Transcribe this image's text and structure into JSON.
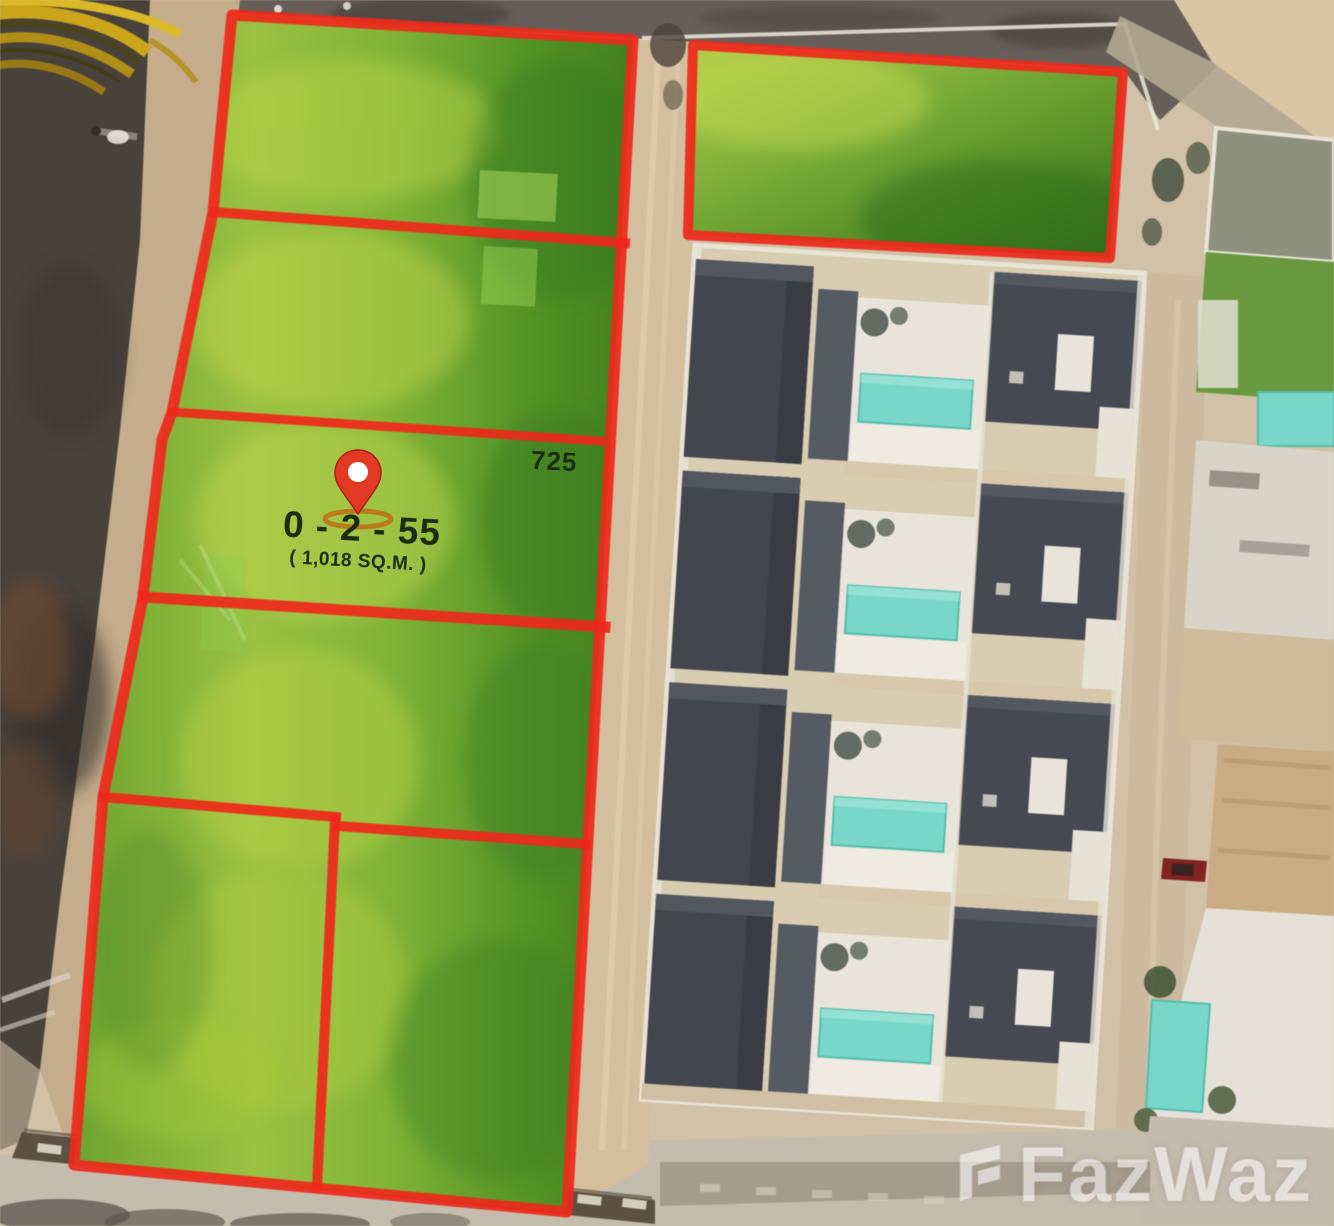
{
  "map": {
    "marker": {
      "icon": "location-pin-icon",
      "plot_label": "0 - 2 - 55",
      "plot_area_label": "( 1,018 SQ.M. )"
    },
    "parcel_number": "725",
    "colors": {
      "boundary_red": "#e8291c",
      "pin_red": "#e23a22",
      "pin_base_ring": "#b97b1b",
      "pool_teal": "#7cd6ca",
      "roof_slate": "#46494f",
      "grass_light": "#a9c944",
      "grass_dark": "#447f20",
      "sand": "#cfc1a8",
      "dirt_dark": "#49423b",
      "label_ink": "#1c2c10",
      "watermark_white": "#ffffff"
    }
  },
  "watermark": {
    "icon": "fazwaz-logo-icon",
    "text": "FazWaz"
  }
}
